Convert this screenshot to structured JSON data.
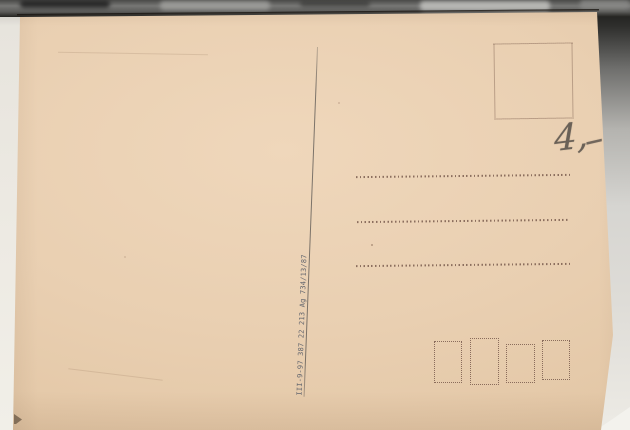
{
  "scene": {
    "description": "Scanned photo of the blank back of a vintage postcard",
    "background_colors": {
      "top_strip": "#55534f",
      "left_strip": "#edeae3",
      "right_strip_top": "#2e2e2c",
      "right_strip_bottom": "#edebe5"
    }
  },
  "postcard": {
    "paper_color": "#e9cfb1",
    "print_ink_color": "#7a5c4e",
    "code_ink_color": "#63666e",
    "pencil_color": "#564e48",
    "printers_code": "III-9-97 387 22 213  Ag 734/13/87",
    "handwritten": {
      "price_figure": "4,",
      "price_dash": "–",
      "price_full": "4,-"
    },
    "stamp_box_count": 1,
    "address_line_count": 3,
    "postal_code_box_count": 4
  }
}
